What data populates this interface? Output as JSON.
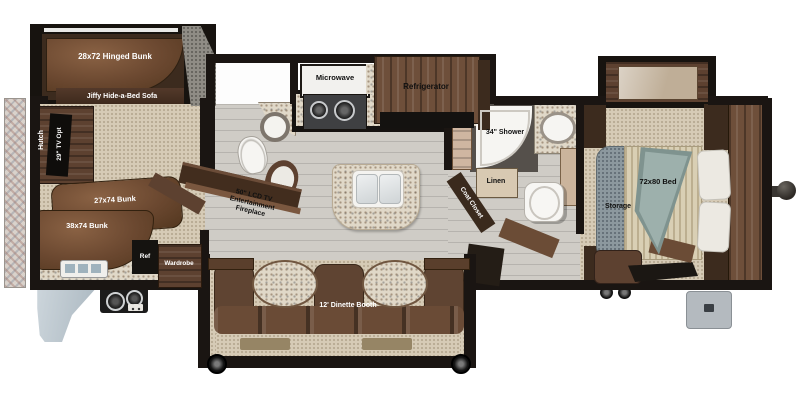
{
  "floorplan": {
    "bunk_room": {
      "hinged_bunk": "28x72 Hinged Bunk",
      "hide_a_bed_sofa": "Jiffy Hide-a-Bed Sofa",
      "hutch": "Hutch",
      "tv_option": "29\" TV Opt",
      "bunk_27": "27x74 Bunk",
      "bunk_38": "38x74 Bunk",
      "refrigerator": "Ref",
      "wardrobe": "Wardrobe"
    },
    "kitchen": {
      "microwave": "Microwave",
      "refrigerator": "Refrigerator"
    },
    "living_area": {
      "entertainment_line1": "50\" LCD TV",
      "entertainment_line2": "Entertainment",
      "entertainment_line3": "Fireplace",
      "dinette": "12' Dinette Booth"
    },
    "bathroom": {
      "shower": "34\" Shower",
      "linen": "Linen",
      "coat_closet": "Coat Closet"
    },
    "bedroom": {
      "bed": "72x80 Bed",
      "storage": "Storage"
    }
  },
  "colors": {
    "wall": "#1a1512",
    "wood_dark": "#3c2b1e",
    "wood_mid": "#6b4a33",
    "wood_light": "#8a6548",
    "floor_plank": "#c9c6c0",
    "carpet": "#d6cbb6",
    "granite": "#e0d8c8",
    "storage_gray": "#8c989e",
    "blanket": "#96a8a4",
    "pillow": "#ece9e2",
    "fender": "#bcc8d0",
    "step": "#b4babf",
    "white_fixture": "#f6f5f2"
  }
}
